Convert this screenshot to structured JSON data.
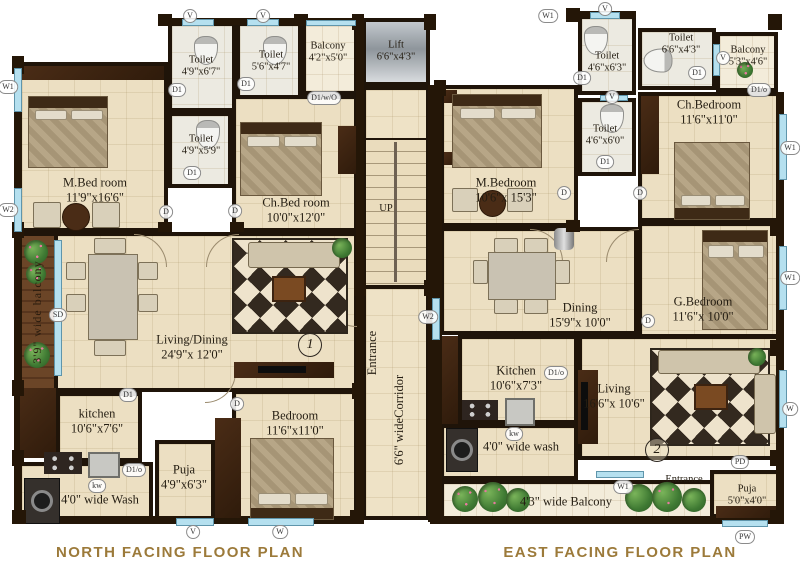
{
  "colors": {
    "wall": "#1f1409",
    "floor": "#ecdfc2",
    "window_blue": "#b5e0ef",
    "wood": "#3c2313",
    "title_gold": "#9c7a3a"
  },
  "titles": {
    "north": "NORTH FACING FLOOR PLAN",
    "east": "EAST FACING FLOOR PLAN"
  },
  "core": {
    "lift_name": "Lift",
    "lift_dims": "6'6\"x4'3\"",
    "up": "UP",
    "entrance": "Entrance",
    "corridor_line1": "6'6\" wide",
    "corridor_line2": "Corridor"
  },
  "north": {
    "unit_no": "1",
    "m_bedroom_name": "M.Bed room",
    "m_bedroom_dims": "11'9\"x16'6\"",
    "toilet1_name": "Toilet",
    "toilet1_dims": "4'9\"x6'7\"",
    "toilet2_name": "Toilet",
    "toilet2_dims": "5'6\"x4'7\"",
    "balcony_name": "Balcony",
    "balcony_dims": "4'2\"x5'0\"",
    "toilet3_name": "Toilet",
    "toilet3_dims": "4'9\"x5'9\"",
    "ch_bedroom_name": "Ch.Bed room",
    "ch_bedroom_dims": "10'0\"x12'0\"",
    "living_name": "Living/Dining",
    "living_dims": "24'9\"x 12'0\"",
    "side_balcony": "3'9\" wide balcony",
    "kitchen_name": "kitchen",
    "kitchen_dims": "10'6\"x7'6\"",
    "wash": "4'0\" wide Wash",
    "puja_name": "Puja",
    "puja_dims": "4'9\"x6'3\"",
    "bedroom_name": "Bedroom",
    "bedroom_dims": "11'6\"x11'0\""
  },
  "east": {
    "unit_no": "2",
    "m_bedroom_name": "M.Bedroom",
    "m_bedroom_dims": "10'6\"x 15'3\"",
    "toilet1_name": "Toilet",
    "toilet1_dims": "4'6\"x6'3\"",
    "toilet2_name": "Toilet",
    "toilet2_dims": "6'6\"x4'3\"",
    "balcony_name": "Balcony",
    "balcony_dims": "5'3\"x4'6\"",
    "toilet3_name": "Toilet",
    "toilet3_dims": "4'6\"x6'0\"",
    "ch_bedroom_name": "Ch.Bedroom",
    "ch_bedroom_dims": "11'6\"x11'0\"",
    "dining_name": "Dining",
    "dining_dims": "15'9\"x 10'0\"",
    "g_bedroom_name": "G.Bedroom",
    "g_bedroom_dims": "11'6\"x 10'0\"",
    "living_name": "Living",
    "living_dims": "16'6\"x 10'6\"",
    "kitchen_name": "Kitchen",
    "kitchen_dims": "10'6\"x7'3\"",
    "wash": "4'0\" wide wash",
    "balcony_bottom": "4'3\" wide Balcony",
    "entrance": "Entrance",
    "puja_name": "Puja",
    "puja_dims": "5'0\"x4'0\""
  },
  "markers": [
    {
      "label": "V",
      "x": 190,
      "y": 16
    },
    {
      "label": "V",
      "x": 263,
      "y": 16
    },
    {
      "label": "W1",
      "x": 8,
      "y": 87
    },
    {
      "label": "W2",
      "x": 8,
      "y": 210
    },
    {
      "label": "D1",
      "x": 177,
      "y": 90
    },
    {
      "label": "D1",
      "x": 246,
      "y": 84
    },
    {
      "label": "D1/w/O",
      "x": 324,
      "y": 98
    },
    {
      "label": "D1",
      "x": 192,
      "y": 173
    },
    {
      "label": "D",
      "x": 166,
      "y": 212
    },
    {
      "label": "D",
      "x": 235,
      "y": 211
    },
    {
      "label": "SD",
      "x": 58,
      "y": 315
    },
    {
      "label": "D1",
      "x": 128,
      "y": 395
    },
    {
      "label": "D1/o",
      "x": 134,
      "y": 470
    },
    {
      "label": "kw",
      "x": 97,
      "y": 486
    },
    {
      "label": "D",
      "x": 237,
      "y": 404
    },
    {
      "label": "V",
      "x": 193,
      "y": 532
    },
    {
      "label": "W",
      "x": 280,
      "y": 532
    },
    {
      "label": "W2",
      "x": 428,
      "y": 317
    },
    {
      "label": "W1",
      "x": 548,
      "y": 16
    },
    {
      "label": "V",
      "x": 605,
      "y": 9
    },
    {
      "label": "D1",
      "x": 582,
      "y": 78
    },
    {
      "label": "V",
      "x": 612,
      "y": 97
    },
    {
      "label": "D1",
      "x": 697,
      "y": 73
    },
    {
      "label": "V",
      "x": 723,
      "y": 58
    },
    {
      "label": "D1/o",
      "x": 759,
      "y": 90
    },
    {
      "label": "D1",
      "x": 605,
      "y": 162
    },
    {
      "label": "D",
      "x": 564,
      "y": 193
    },
    {
      "label": "D",
      "x": 640,
      "y": 193
    },
    {
      "label": "W1",
      "x": 790,
      "y": 148
    },
    {
      "label": "W1",
      "x": 790,
      "y": 278
    },
    {
      "label": "D",
      "x": 648,
      "y": 321
    },
    {
      "label": "W",
      "x": 790,
      "y": 409
    },
    {
      "label": "D1/o",
      "x": 556,
      "y": 373
    },
    {
      "label": "kw",
      "x": 514,
      "y": 434
    },
    {
      "label": "W1",
      "x": 623,
      "y": 487
    },
    {
      "label": "PD",
      "x": 740,
      "y": 462
    },
    {
      "label": "PW",
      "x": 745,
      "y": 537
    }
  ]
}
